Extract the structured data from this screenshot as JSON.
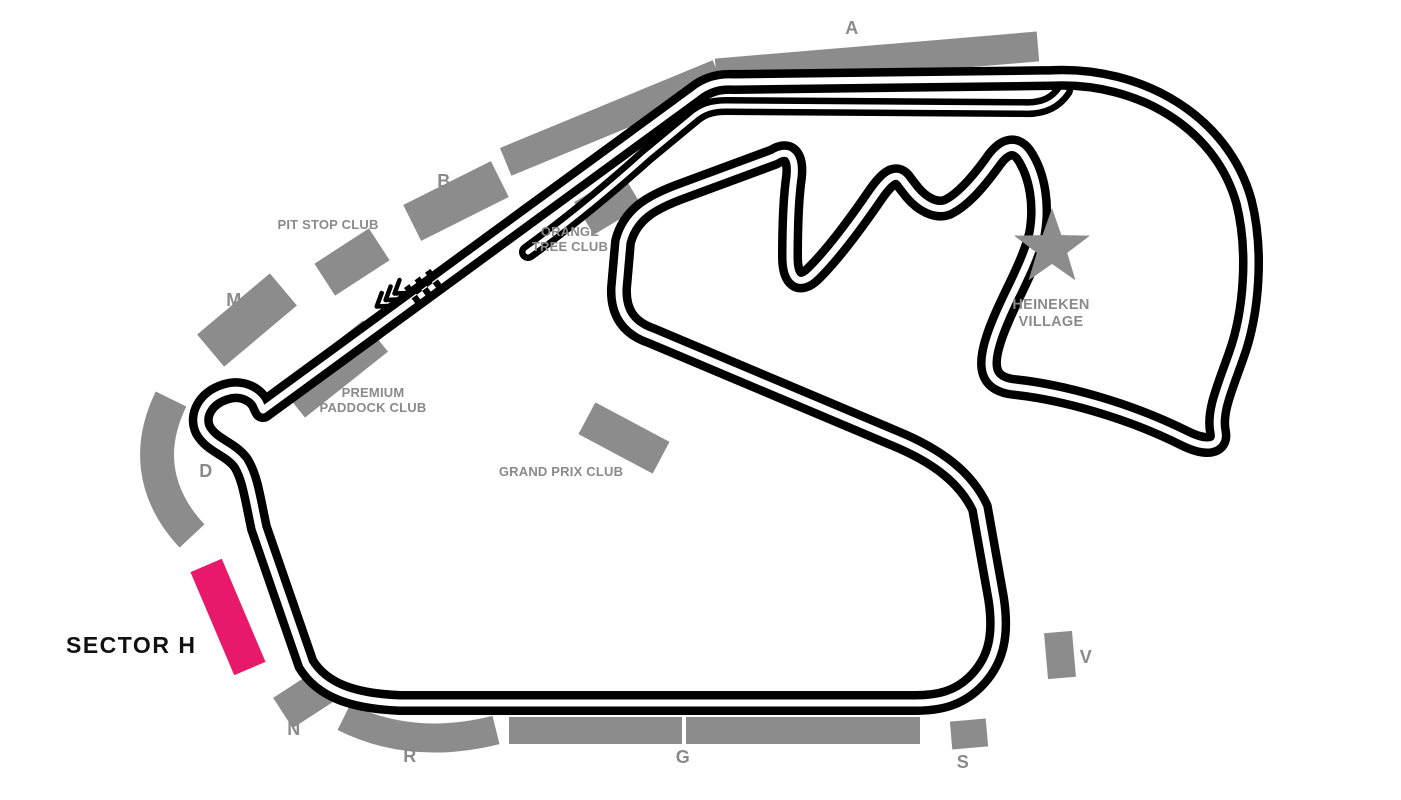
{
  "colors": {
    "background": "#ffffff",
    "track": "#000000",
    "road": "#ffffff",
    "stand": "#8c8c8c",
    "label": "#8a8a8a",
    "highlight": "#e8196b",
    "highlight_text": "#111111"
  },
  "highlight": {
    "label": "SECTOR H"
  },
  "grandstands": {
    "a": "A",
    "b": "B",
    "m": "M",
    "d": "D",
    "n": "N",
    "r": "R",
    "g": "G",
    "s": "S",
    "v": "V"
  },
  "clubs": {
    "pit_stop": "PIT STOP CLUB",
    "orange_tree_line1": "ORANGE",
    "orange_tree_line2": "TREE CLUB",
    "premium_line1": "PREMIUM",
    "premium_line2": "PADDOCK CLUB",
    "grand_prix": "GRAND PRIX CLUB",
    "heineken_line1": "HEINEKEN",
    "heineken_line2": "VILLAGE"
  },
  "icons": {
    "start_finish": "checkered-flag",
    "direction": "chevrons-left",
    "village": "star"
  }
}
